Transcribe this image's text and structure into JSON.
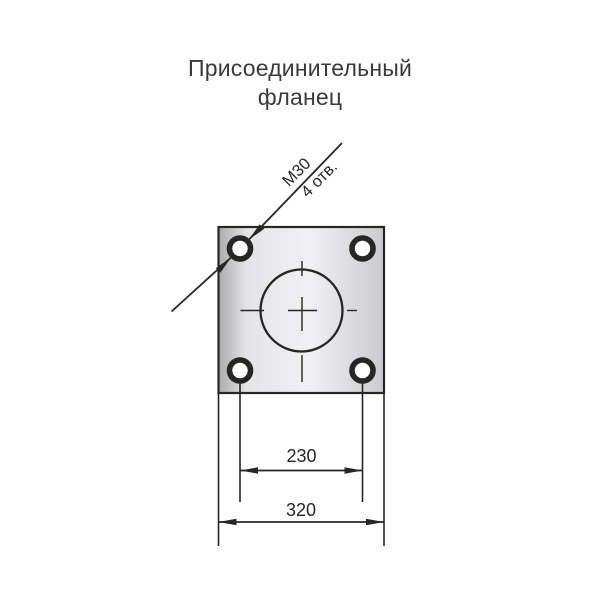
{
  "page": {
    "background": "#ffffff"
  },
  "title": {
    "line1": "Присоединительный",
    "line2": "фланец"
  },
  "callout": {
    "thread": "М30",
    "hole_count": "4 отв."
  },
  "dimensions": {
    "bolt_spacing": "230",
    "flange_width": "320"
  },
  "drawing": {
    "colors": {
      "page_bg": "#ffffff",
      "ink": "#262626",
      "title_text": "#3a3a3a",
      "hole_fill": "#ffffff",
      "plate_edge_shade": "#ababae",
      "plate_light": "#e4e4e6",
      "plate_mid_light": "#f1f1f3",
      "plate_right_shade": "#cbcbce"
    }
  }
}
